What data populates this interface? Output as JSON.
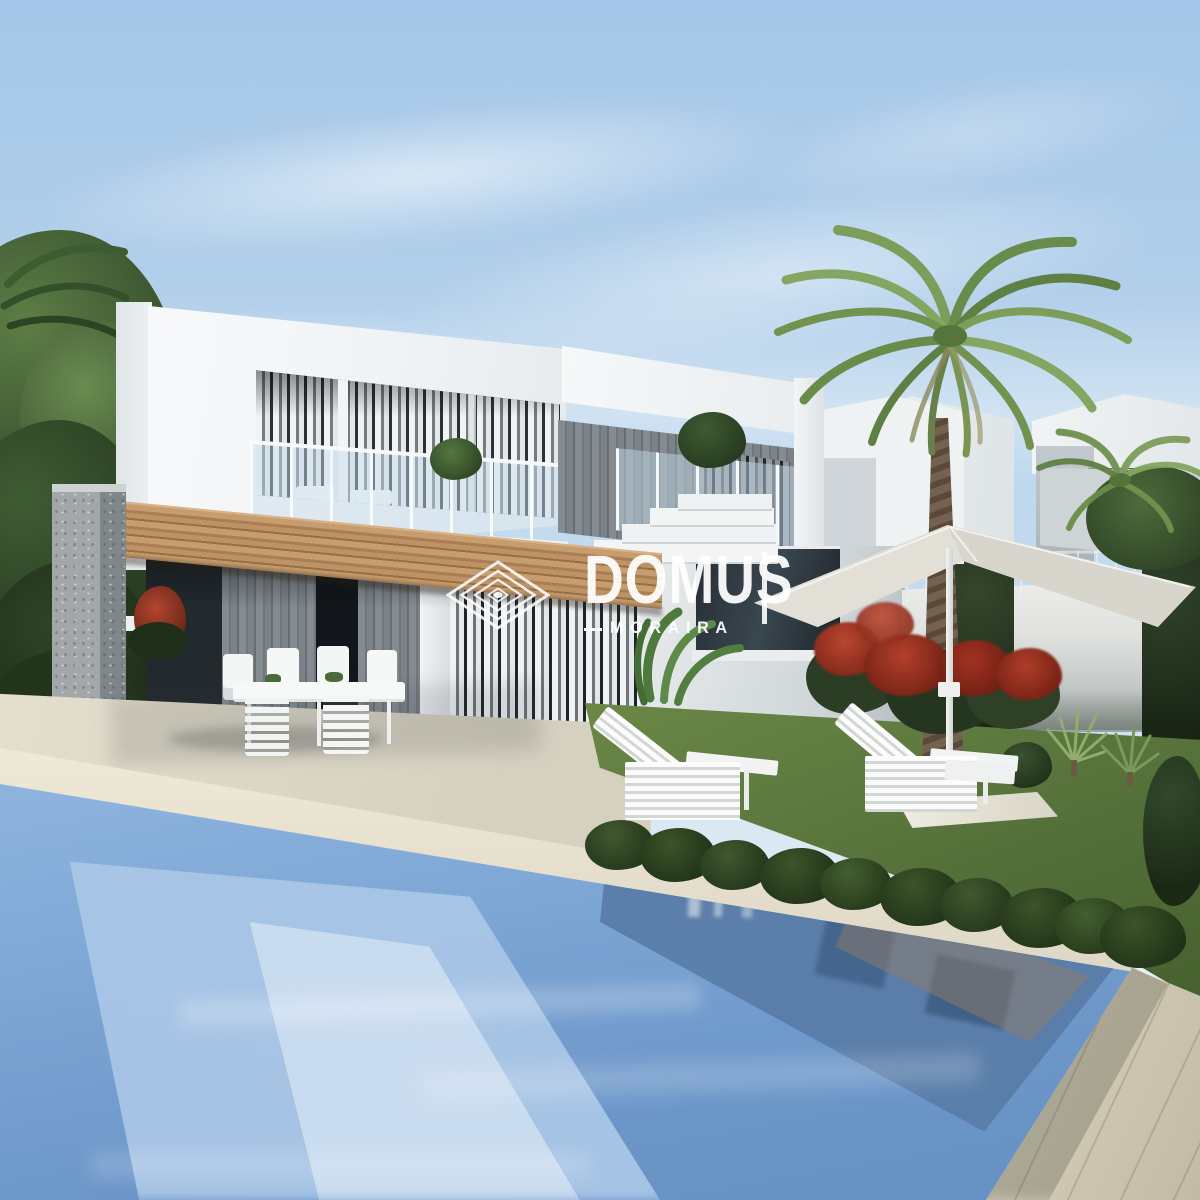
{
  "watermark": {
    "brand": "DOMUS",
    "location": "MORAIRA"
  },
  "icons": {
    "brand_mark": "nested-diamonds-icon",
    "scene_items": [
      "palm-tree",
      "parasol",
      "sun-lounger",
      "pergola",
      "swimming-pool",
      "dining-set"
    ]
  },
  "colors": {
    "sky_top": "#a3c6e8",
    "sky_bottom": "#d9e7f3",
    "villa_white": "#f5f7f8",
    "villa_shadow": "#cfd6da",
    "stone_cladding": "#788086",
    "stone_pillar": "#9aa0a3",
    "pergola_wood": "#bd9266",
    "curtain_white": "#eef1f2",
    "glass_tint": "#c7dcec",
    "terrace_stone": "#ded8c8",
    "pool_coping": "#eae4d4",
    "pool_water": "#7ea7d6",
    "pool_water_deep": "#5c80ab",
    "pool_reflection": "#a9c6e6",
    "deck_stone": "#d8d1bf",
    "grass_green": "#5e7a3c",
    "foliage_dark": "#2c3e26",
    "foliage_light": "#6f9350",
    "flower_red": "#a83a28",
    "palm_trunk": "#6a594a",
    "umbrella_canvas": "#e2dfd6",
    "boundary_wall": "#dfe1df",
    "roof_terracotta": "#b06a4f",
    "watermark": "#ffffff"
  }
}
